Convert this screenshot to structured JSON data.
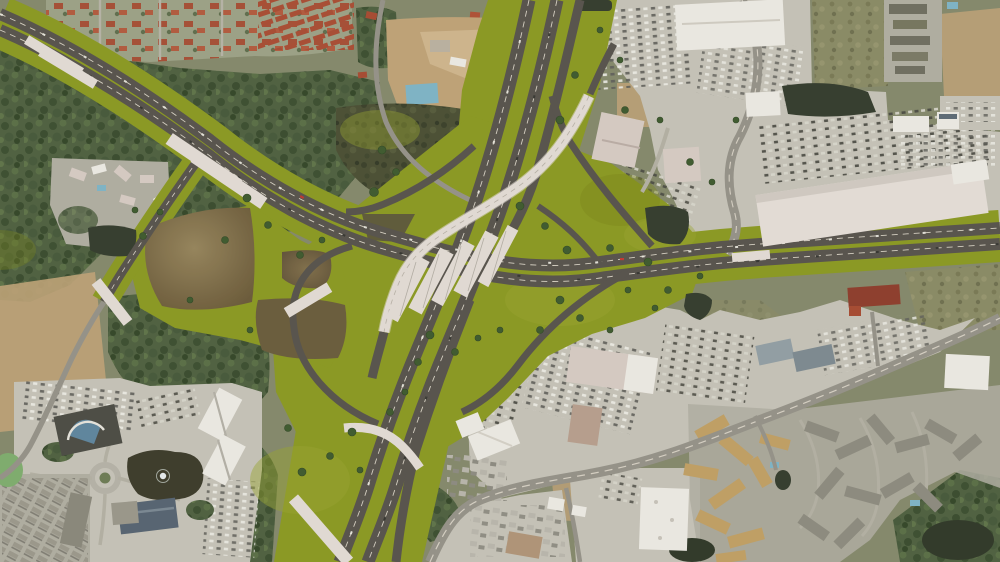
{
  "meta": {
    "type": "aerial-photo-render",
    "description": "Aerial rendering of a proposed freeway-to-freeway interchange: olive-green landscaped right-of-way, multi-deck bridges, flyover ramp, toll gantries, retention ponds, surrounded by shopping centers, parking lots, apartment complexes, forest and construction areas",
    "width_px": 1000,
    "height_px": 562
  },
  "palette": {
    "base": "#85896c",
    "olive": "#8c9a21",
    "oliveLight": "#9aa72f",
    "oliveDark": "#7a8819",
    "road": "#57534c",
    "roadFaint": "#6b665e",
    "laneMark": "#d8d2c6",
    "bridge": "#e5ded7",
    "bridgeShade": "#c9c0ba",
    "urban": "#c8c5ba",
    "urbanShade": "#b2afa3",
    "dirt": "#c1a478",
    "scrub": "#8b8c66",
    "forest": "#4e6040",
    "marsh": "#4a4f33",
    "pondBrownHi": "#97855c",
    "pondBrownLo": "#6b5a39",
    "pondDark": "#333b2d",
    "pondGreen": "#7fae6e",
    "poolBlue": "#7fb6c9",
    "whiteRoof": "#efece6",
    "pinkBldg": "#d9cdc6",
    "tanRoof": "#c2a165",
    "grayRoof": "#8e8c80",
    "blueRoof": "#5d6b77",
    "darkBldg": "#4b4b44",
    "redRoof": "#a84a31",
    "ctxRoad": "#96938a",
    "ctxRoadLight": "#b5b2a5",
    "carLight": "#eceae2",
    "carDark": "#33332f"
  },
  "scene": {
    "highways": [
      {
        "name": "east-west-toll-highway",
        "orientation": "NW corner to E edge",
        "toll_gantries": 3
      },
      {
        "name": "north-south-freeway",
        "orientation": "top edge to bottom edge",
        "carriageways": 3
      }
    ],
    "interchange": {
      "name": "freeway-interchange",
      "bridge_decks": 5,
      "flyover_ramps": 2,
      "loop_ramps": 2,
      "retention_ponds": 3
    },
    "landmarks": [
      {
        "name": "shopping-center-northeast",
        "features": [
          "big-box-store",
          "retail-strip",
          "parking-lots"
        ]
      },
      {
        "name": "construction-site-north",
        "features": [
          "graded-dirt",
          "blue-pool"
        ]
      },
      {
        "name": "red-roof-residential-northwest"
      },
      {
        "name": "resort-campus-southwest",
        "features": [
          "dark-roof-hotel",
          "lake-with-fountain",
          "roundabout",
          "white-office-buildings"
        ]
      },
      {
        "name": "apartment-complexes-southeast",
        "features": [
          "tan-roofs",
          "gray-roofs",
          "pools"
        ]
      },
      {
        "name": "marsh-pond-north"
      },
      {
        "name": "swamp-southeast-corner"
      },
      {
        "name": "arterial-boulevard-south"
      }
    ]
  }
}
